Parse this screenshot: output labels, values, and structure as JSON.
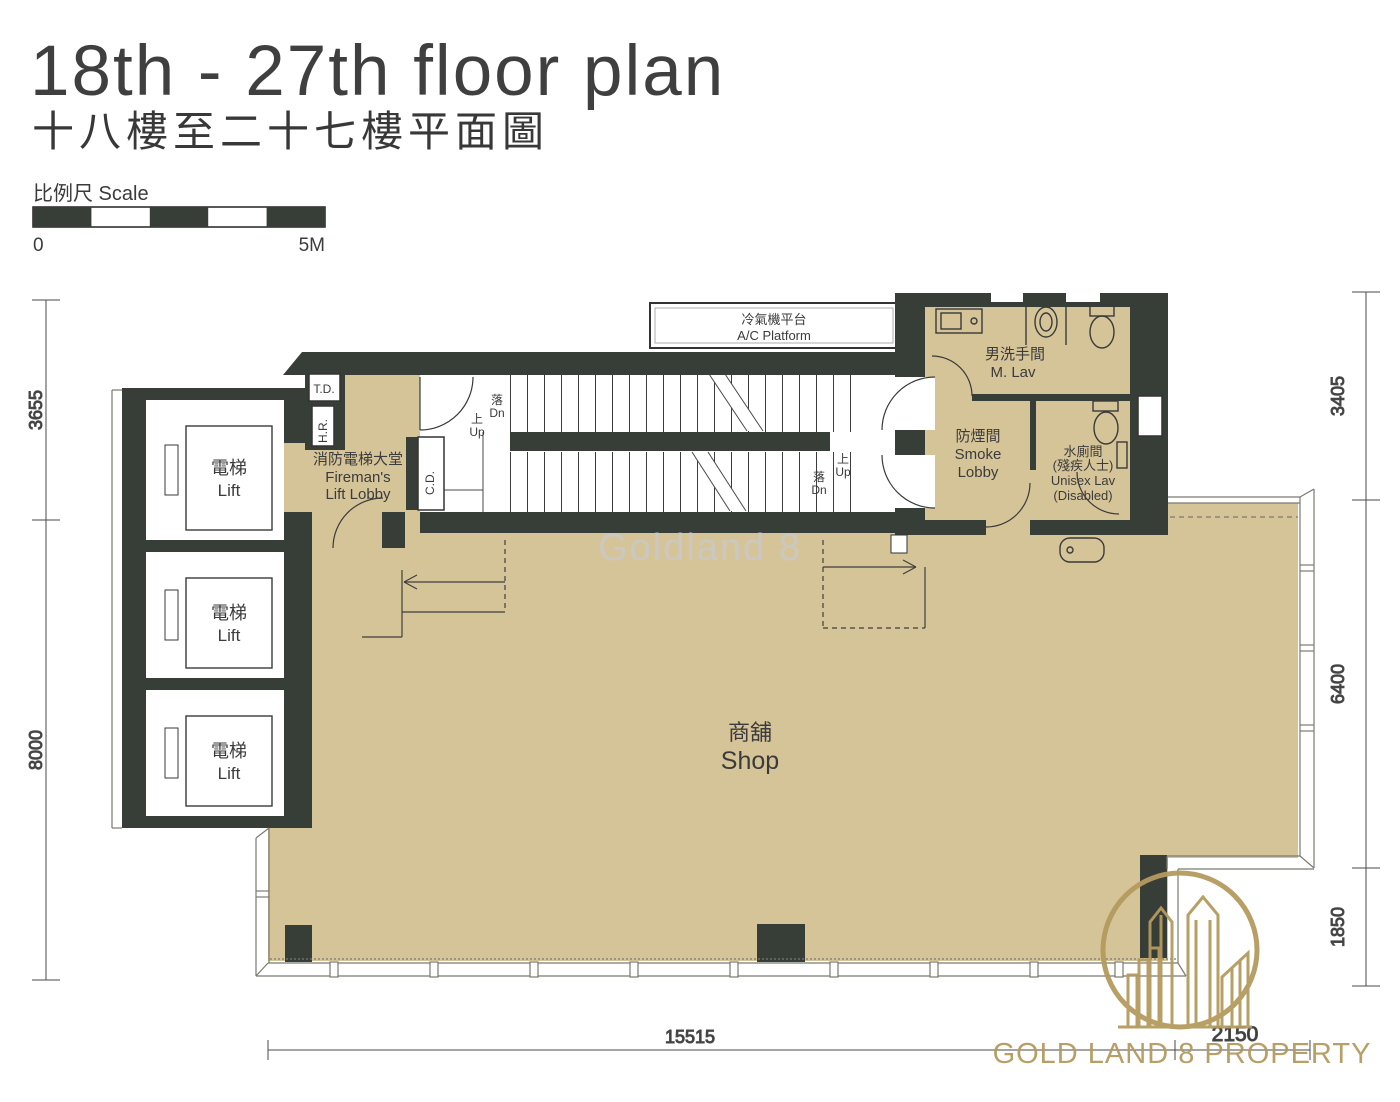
{
  "header": {
    "title_en": "18th - 27th floor plan",
    "title_zh": "十八樓至二十七樓平面圖"
  },
  "scale_bar": {
    "label": "比例尺 Scale",
    "min": "0",
    "max": "5M"
  },
  "dimensions": {
    "left": [
      "3655",
      "8000"
    ],
    "right": [
      "3405",
      "6400",
      "1850"
    ],
    "bottom": [
      "15515",
      "2150"
    ]
  },
  "rooms": {
    "lift_zh": "電梯",
    "lift_en": "Lift",
    "fireman_lobby_zh": "消防電梯大堂",
    "fireman_lobby_en1": "Fireman's",
    "fireman_lobby_en2": "Lift Lobby",
    "shop_zh": "商舖",
    "shop_en": "Shop",
    "m_lav_zh": "男洗手間",
    "m_lav_en": "M. Lav",
    "smoke_lobby_zh": "防煙間",
    "smoke_lobby_en1": "Smoke",
    "smoke_lobby_en2": "Lobby",
    "unisex_lav_zh1": "水廁間",
    "unisex_lav_zh2": "(殘疾人士)",
    "unisex_lav_en1": "Unisex Lav",
    "unisex_lav_en2": "(Disabled)",
    "ac_platform_zh": "冷氣機平台",
    "ac_platform_en": "A/C Platform"
  },
  "stairs": {
    "up_zh": "上",
    "up_en": "Up",
    "dn_zh": "落",
    "dn_en": "Dn"
  },
  "shafts": {
    "td": "T.D.",
    "hr": "H.R.",
    "cd": "C.D."
  },
  "watermark": "Goldland 8",
  "logo_text": "GOLD LAND 8 PROPERTY",
  "colors": {
    "wall": "#373d37",
    "floor": "#d6c499",
    "logo_gold": "#b49a5e",
    "watermark_gray": "#c9c9c9"
  }
}
